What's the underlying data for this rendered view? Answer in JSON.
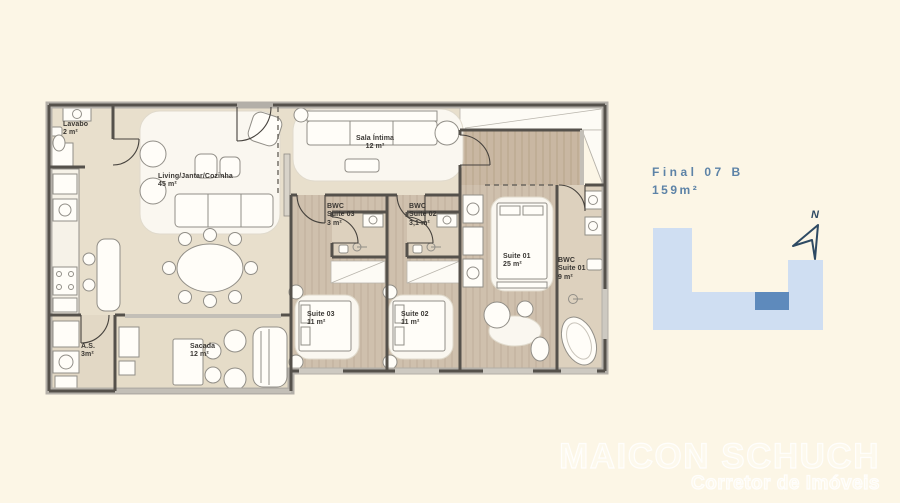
{
  "unit": {
    "label": "Final 07 B",
    "area": "159m²"
  },
  "compass": {
    "north_label": "N"
  },
  "rooms": {
    "lavabo": {
      "name": "Lavabo",
      "area": "2 m²"
    },
    "living": {
      "name": "Living/Jantar/Cozinha",
      "area": "45 m²"
    },
    "sala_intima": {
      "name": "Sala Íntima",
      "area": "12 m²"
    },
    "bwc_suite_03": {
      "name": "BWC",
      "sub": "Suite 03",
      "area": "3 m²"
    },
    "bwc_suite_02": {
      "name": "BWC",
      "sub": "Suite 02",
      "area": "3,1 m²"
    },
    "bwc_suite_01": {
      "name": "BWC",
      "sub": "Suite 01",
      "area": "9 m²"
    },
    "suite_01": {
      "name": "Suite 01",
      "area": "25 m²"
    },
    "suite_02": {
      "name": "Suite 02",
      "area": "11 m²"
    },
    "suite_03": {
      "name": "Suite 03",
      "area": "11 m²"
    },
    "servico": {
      "name": "A.S.",
      "area": "3m²"
    },
    "sacada": {
      "name": "Sacada",
      "area": "12 m²"
    }
  },
  "watermark": {
    "line1": "MAICON SCHUCH",
    "line2": "Corretor de Imóveis"
  },
  "colors": {
    "background": "#fcf6e6",
    "accent": "#5d83a7",
    "wall": "#55514b",
    "bwc_floor": "#ddd1be",
    "footprint_light": "#cfdef2",
    "footprint_dark": "#5e8abc",
    "compass": "#2e4a63",
    "label_text": "#3a3733"
  }
}
